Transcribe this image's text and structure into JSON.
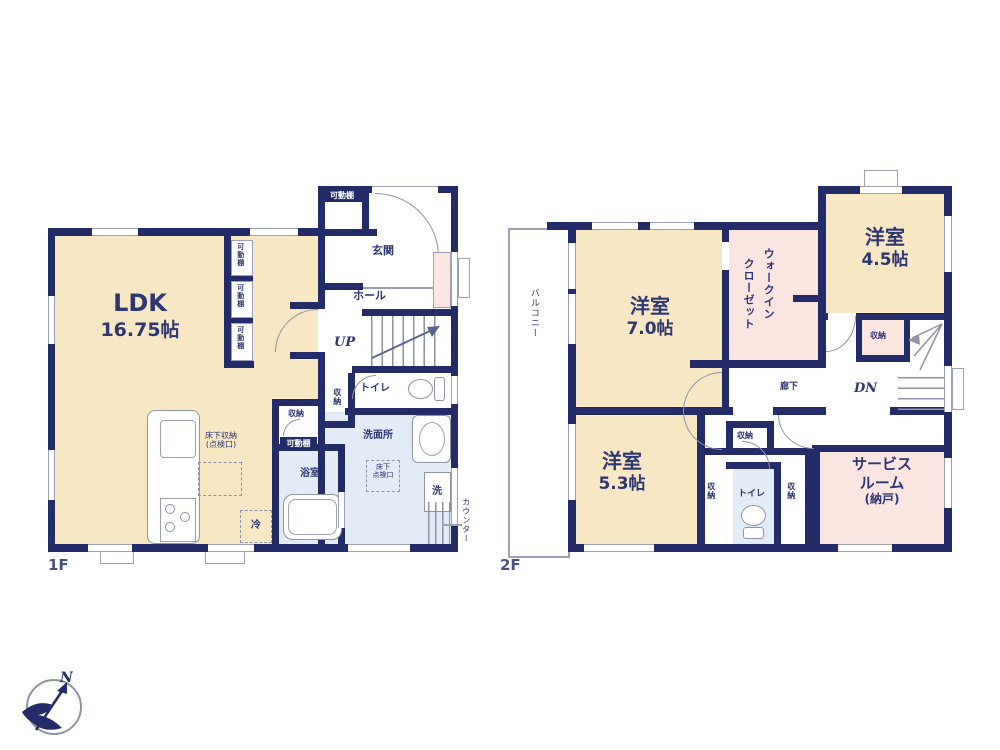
{
  "colors": {
    "wall": "#232c68",
    "room_cream": "#f7e7c2",
    "room_pink": "#fbe5e1",
    "room_blue": "#e3ebf6",
    "line": "#9aa0b6",
    "ink": "#2e3674"
  },
  "f1": {
    "label": "1F",
    "ldk_name": "LDK",
    "ldk_size": "16.75帖",
    "genkan": "玄関",
    "hall": "ホール",
    "up": "UP",
    "toilet": "トイレ",
    "senmenjo": "洗面所",
    "yokushitsu": "浴室",
    "kadodana": "可動棚",
    "shuno": "収納",
    "yukashita_shuno": "床下収納",
    "yukashita_shuno_sub": "(点検口)",
    "yukashita_tenken_1": "床下",
    "yukashita_tenken_2": "点検口",
    "fridge": "冷",
    "washer": "洗",
    "counter": "カウンター"
  },
  "f2": {
    "label": "2F",
    "room7_name": "洋室",
    "room7_size": "7.0帖",
    "room45_name": "洋室",
    "room45_size": "4.5帖",
    "room53_name": "洋室",
    "room53_size": "5.3帖",
    "wic_1": "ウォークイン",
    "wic_2": "クローゼット",
    "balcony": "バルコニー",
    "corridor": "廊下",
    "dn": "DN",
    "toilet": "トイレ",
    "shuno": "収納",
    "service_1": "サービス",
    "service_2": "ルーム",
    "service_3": "(納戸)"
  },
  "compass": {
    "north": "N"
  }
}
